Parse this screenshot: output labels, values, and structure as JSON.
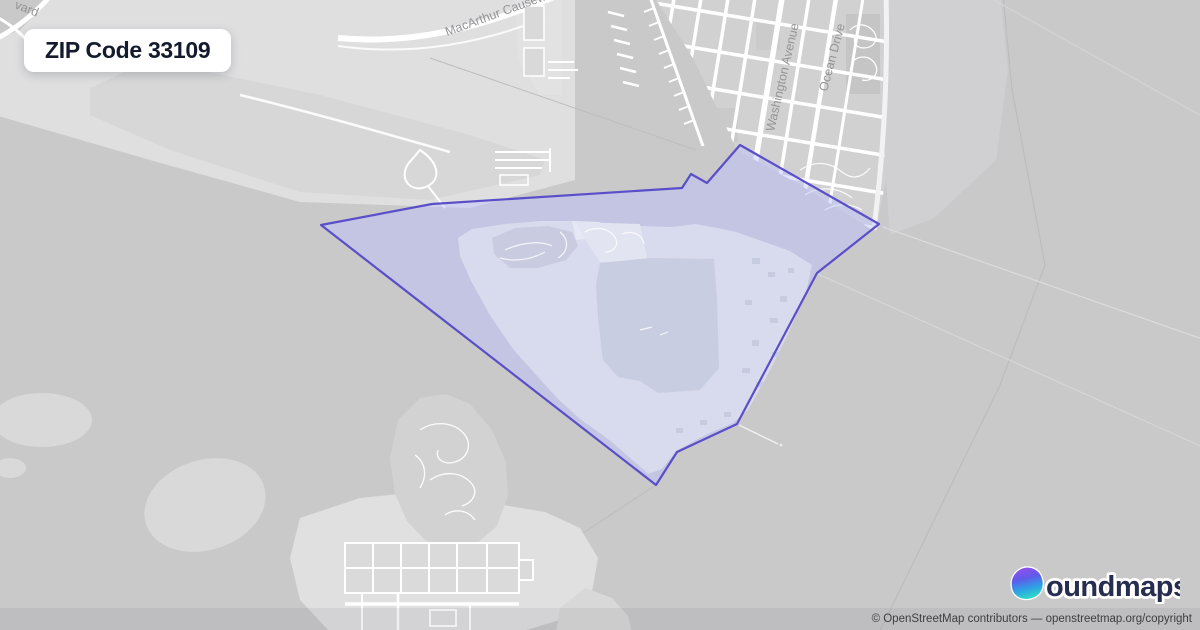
{
  "badge": {
    "label": "ZIP Code 33109"
  },
  "map": {
    "street_labels": [
      {
        "id": "macarthur-causeway",
        "text": "MacArthur Causeway"
      },
      {
        "id": "boulevard-partial",
        "text": "vard"
      },
      {
        "id": "washington-avenue",
        "text": "Washington Avenue"
      },
      {
        "id": "ocean-drive",
        "text": "Ocean Drive"
      }
    ],
    "zip_boundary": {
      "zip_code": "33109",
      "stroke": "#5a4fc9",
      "fill": "rgba(188,193,255,0.45)",
      "points": "321,225 432,204 682,188 691,174 707,183 740,145 879,224 817,273 737,424 677,452 656,485"
    },
    "label_color": "#949497"
  },
  "logo": {
    "text": "boundmaps",
    "wordmark": "oundmaps",
    "icon": "droplet-gradient-icon",
    "navy": "#272d4f",
    "gradient": [
      "#9b4dee",
      "#5f5bea",
      "#2e9fe6",
      "#2ed3c9"
    ]
  },
  "attribution": {
    "contributors_text": "© OpenStreetMap contributors",
    "dash": "—",
    "link_text": "openstreetmap.org/copyright"
  }
}
